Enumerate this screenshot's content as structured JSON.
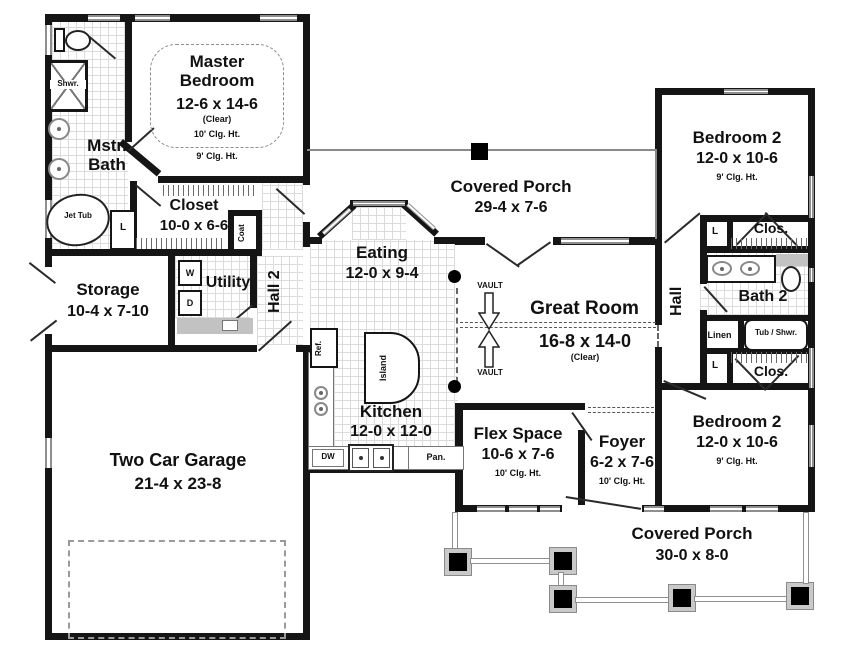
{
  "rooms": [
    {
      "name": "Master Bedroom",
      "dims": "12-6 x 14-6",
      "note": "(Clear)",
      "ceil": "10' Clg. Ht.",
      "ceil2": "9' Clg. Ht."
    },
    {
      "name": "Mstr. Bath"
    },
    {
      "name": "Closet",
      "dims": "10-0 x 6-6"
    },
    {
      "name": "Storage",
      "dims": "10-4 x 7-10"
    },
    {
      "name": "Utility"
    },
    {
      "name": "Hall 2"
    },
    {
      "name": "Eating",
      "dims": "12-0 x 9-4"
    },
    {
      "name": "Covered Porch",
      "dims": "29-4 x 7-6"
    },
    {
      "name": "Kitchen",
      "dims": "12-0 x 12-0"
    },
    {
      "name": "Great Room",
      "dims": "16-8 x 14-0",
      "note": "(Clear)"
    },
    {
      "name": "Flex Space",
      "dims": "10-6 x 7-6",
      "ceil": "10' Clg. Ht."
    },
    {
      "name": "Foyer",
      "dims": "6-2 x 7-6",
      "ceil": "10' Clg. Ht."
    },
    {
      "name": "Hall"
    },
    {
      "name": "Bedroom 2",
      "dims": "12-0 x 10-6",
      "ceil": "9' Clg. Ht."
    },
    {
      "name": "Bath 2"
    },
    {
      "name": "Bedroom 2",
      "dims": "12-0 x 10-6",
      "ceil": "9' Clg. Ht."
    },
    {
      "name": "Covered Porch",
      "dims": "30-0 x 8-0"
    },
    {
      "name": "Two Car Garage",
      "dims": "21-4 x 23-8"
    }
  ],
  "fixtures": {
    "shower": "Shwr.",
    "jet_tub": "Jet Tub",
    "linen_small": "L",
    "coat": "Coat",
    "washer": "W",
    "dryer": "D",
    "fridge": "Ref.",
    "island": "Island",
    "dishwasher": "DW",
    "pantry": "Pan.",
    "linen": "Linen",
    "tub_shower": "Tub / Shwr.",
    "closet_abbr": "Clos.",
    "vault": "VAULT"
  },
  "colors": {
    "wall": "#151515",
    "window_frame": "#8f8f8f",
    "grid_line": "#dcdcdc"
  }
}
